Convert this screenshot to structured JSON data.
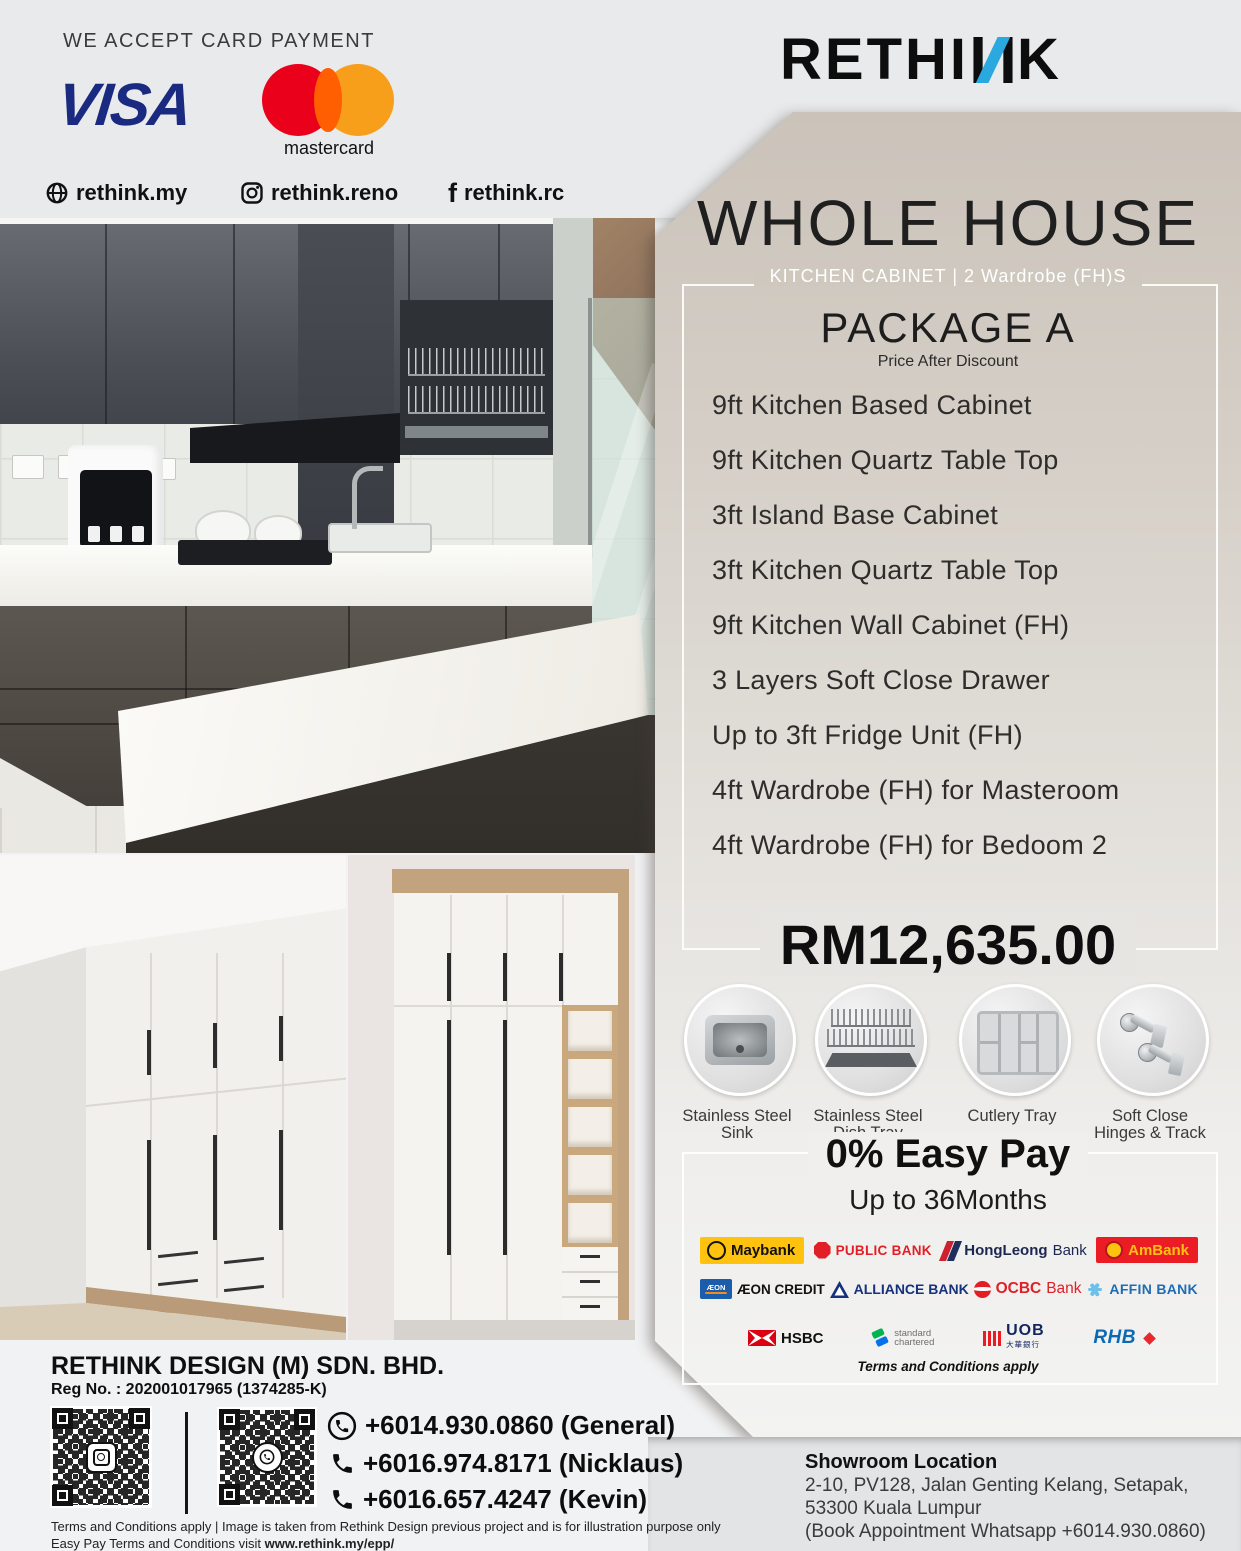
{
  "header": {
    "card_payment": "WE ACCEPT CARD PAYMENT",
    "visa": "VISA",
    "mastercard": "mastercard",
    "links": [
      {
        "label": "rethink.my"
      },
      {
        "label": "rethink.reno"
      },
      {
        "label": "rethink.rc"
      }
    ],
    "brand": {
      "part1": "RETHI",
      "accent_letter": "N",
      "part2": "K"
    }
  },
  "package": {
    "title": "WHOLE HOUSE",
    "subtitle": "KITCHEN CABINET | 2 Wardrobe (FH)S",
    "name": "PACKAGE A",
    "note": "Price After Discount",
    "items": [
      "9ft Kitchen Based Cabinet",
      "9ft Kitchen Quartz Table Top",
      "3ft Island Base Cabinet",
      "3ft Kitchen Quartz Table Top",
      "9ft Kitchen Wall Cabinet (FH)",
      "3 Layers Soft Close Drawer",
      "Up to 3ft Fridge Unit (FH)",
      "4ft Wardrobe (FH) for Masteroom",
      "4ft Wardrobe (FH) for Bedoom 2"
    ],
    "price": "RM12,635.00"
  },
  "features": [
    {
      "line1": "Stainless Steel",
      "line2": "Sink"
    },
    {
      "line1": "Stainless Steel",
      "line2": "Dish Tray"
    },
    {
      "line1": "Cutlery Tray",
      "line2": ""
    },
    {
      "line1": "Soft Close",
      "line2": "Hinges & Track"
    }
  ],
  "easy_pay": {
    "title": "0% Easy Pay",
    "subtitle": "Up to 36Months",
    "terms": "Terms and Conditions apply",
    "banks": {
      "maybank": "Maybank",
      "public_bank": "PUBLIC BANK",
      "hong_leong_bold": "HongLeong",
      "hong_leong_rest": "Bank",
      "ambank": "AmBank",
      "aeon_box": "ÆON",
      "aeon": "ÆON CREDIT",
      "alliance": "ALLIANCE BANK",
      "ocbc_red": "OCBC",
      "ocbc_rest": "Bank",
      "affin": "AFFIN BANK",
      "hsbc": "HSBC",
      "sc_line1": "standard",
      "sc_line2": "chartered",
      "uob": "UOB",
      "uob_sub": "大華銀行",
      "rhb": "RHB"
    }
  },
  "company": {
    "name": "RETHINK DESIGN (M) SDN. BHD.",
    "reg": "Reg No. : 202001017965 (1374285-K)",
    "phones": [
      {
        "number": "+6014.930.0860 (General)"
      },
      {
        "number": "+6016.974.8171 (Nicklaus)"
      },
      {
        "number": "+6016.657.4247 (Kevin)"
      }
    ],
    "terms_line1": "Terms and Conditions apply | Image is taken from Rethink Design previous project and is for illustration purpose only",
    "terms_line2_prefix": "Easy Pay Terms and Conditions visit ",
    "terms_line2_url": "www.rethink.my/epp/"
  },
  "showroom": {
    "heading": "Showroom Location",
    "line1": "2-10, PV128, Jalan Genting Kelang, Setapak,",
    "line2": "53300 Kuala Lumpur",
    "line3": "(Book Appointment Whatsapp +6014.930.0860)"
  },
  "colors": {
    "accent_blue": "#2aa9e0",
    "panel_beige": "#d2ccc4",
    "visa_blue": "#1a2a80",
    "mastercard_red": "#eb001b",
    "mastercard_orange": "#f79e1b"
  }
}
